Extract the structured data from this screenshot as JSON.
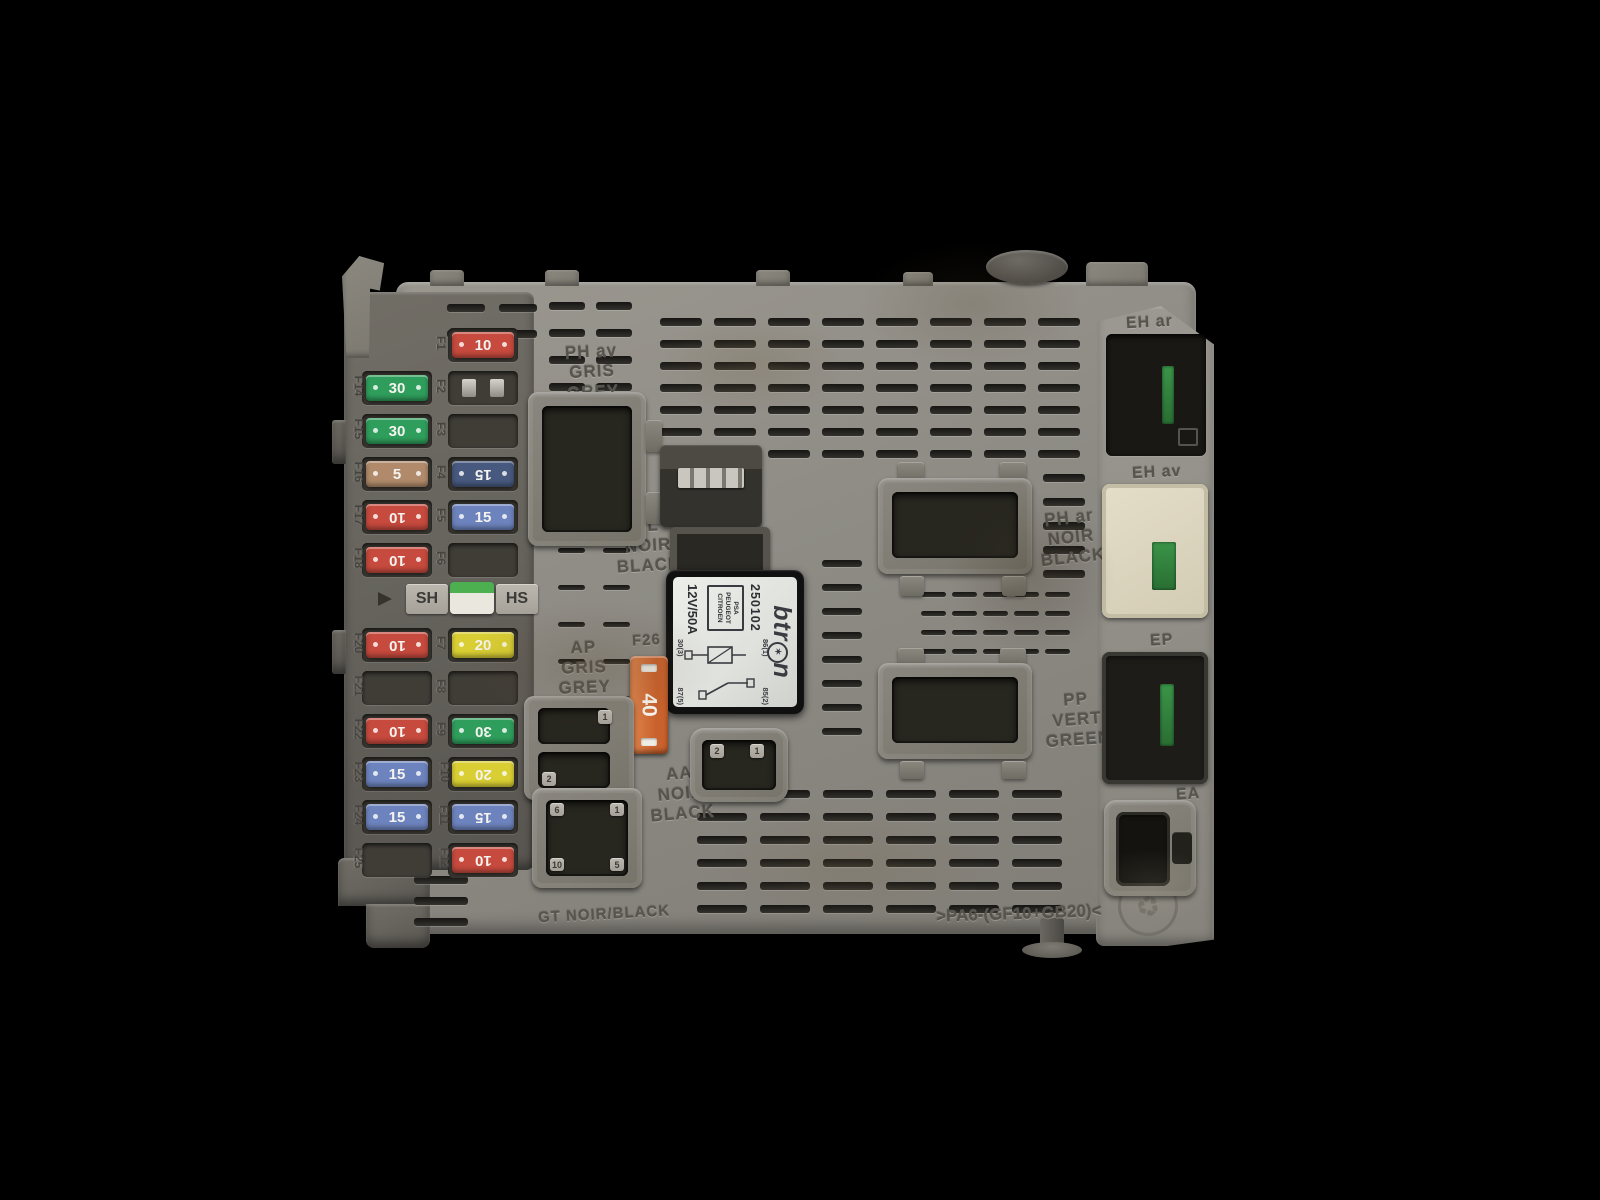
{
  "photo": {
    "background": "#000000",
    "subject": "Grey automotive BSI fuse and relay box module photographed from above on a black background"
  },
  "colors": {
    "red10": "#c64a3e",
    "green30": "#2f9e5c",
    "tan5": "#b08a6b",
    "navy15": "#47597e",
    "blue15": "#6d83bd",
    "yellow20": "#d9ce33",
    "orange40": "#d4703a",
    "sh_green": "#4caf50",
    "body_grey": "#8e8b85",
    "pcb_green": "#2f7d3c"
  },
  "fuse_panel": {
    "sh_label": "SH",
    "hs_label": "HS",
    "left_labels": [
      {
        "label": "F14",
        "group": "upper",
        "row": 1
      },
      {
        "label": "F15",
        "group": "upper",
        "row": 2
      },
      {
        "label": "F16",
        "group": "upper",
        "row": 3
      },
      {
        "label": "F17",
        "group": "upper",
        "row": 4
      },
      {
        "label": "F18",
        "group": "upper",
        "row": 5
      },
      {
        "label": "F20",
        "group": "lower",
        "row": 0
      },
      {
        "label": "F21",
        "group": "lower",
        "row": 1
      },
      {
        "label": "F22",
        "group": "lower",
        "row": 2
      },
      {
        "label": "F23",
        "group": "lower",
        "row": 3
      },
      {
        "label": "F24",
        "group": "lower",
        "row": 4
      },
      {
        "label": "F25",
        "group": "lower",
        "row": 5
      }
    ],
    "mid_labels": [
      {
        "label": "F1",
        "group": "upper",
        "row": 0
      },
      {
        "label": "F2",
        "group": "upper",
        "row": 1
      },
      {
        "label": "F3",
        "group": "upper",
        "row": 2
      },
      {
        "label": "F4",
        "group": "upper",
        "row": 3
      },
      {
        "label": "F5",
        "group": "upper",
        "row": 4
      },
      {
        "label": "F6",
        "group": "upper",
        "row": 5
      },
      {
        "label": "F7",
        "group": "lower",
        "row": 0
      },
      {
        "label": "F8",
        "group": "lower",
        "row": 1
      },
      {
        "label": "F9",
        "group": "lower",
        "row": 2
      },
      {
        "label": "F10",
        "group": "lower",
        "row": 3
      },
      {
        "label": "F11",
        "group": "lower",
        "row": 4
      },
      {
        "label": "F12",
        "group": "lower",
        "row": 5
      }
    ],
    "fuses": [
      {
        "slot": "F1",
        "group": "upper",
        "col": "right",
        "row": 0,
        "type": "fuse",
        "value": "10",
        "color": "red10",
        "flipped": false
      },
      {
        "slot": "F2",
        "group": "upper",
        "col": "right",
        "row": 1,
        "type": "clips"
      },
      {
        "slot": "F3",
        "group": "upper",
        "col": "right",
        "row": 2,
        "type": "empty"
      },
      {
        "slot": "F4",
        "group": "upper",
        "col": "right",
        "row": 3,
        "type": "fuse",
        "value": "15",
        "color": "navy15",
        "flipped": true
      },
      {
        "slot": "F5",
        "group": "upper",
        "col": "right",
        "row": 4,
        "type": "fuse",
        "value": "15",
        "color": "blue15",
        "flipped": false
      },
      {
        "slot": "F6",
        "group": "upper",
        "col": "right",
        "row": 5,
        "type": "empty"
      },
      {
        "slot": "F14",
        "group": "upper",
        "col": "left",
        "row": 1,
        "type": "fuse",
        "value": "30",
        "color": "green30",
        "flipped": false
      },
      {
        "slot": "F15",
        "group": "upper",
        "col": "left",
        "row": 2,
        "type": "fuse",
        "value": "30",
        "color": "green30",
        "flipped": false
      },
      {
        "slot": "F16",
        "group": "upper",
        "col": "left",
        "row": 3,
        "type": "fuse",
        "value": "5",
        "color": "tan5",
        "flipped": false
      },
      {
        "slot": "F17",
        "group": "upper",
        "col": "left",
        "row": 4,
        "type": "fuse",
        "value": "10",
        "color": "red10",
        "flipped": true
      },
      {
        "slot": "F18",
        "group": "upper",
        "col": "left",
        "row": 5,
        "type": "fuse",
        "value": "10",
        "color": "red10",
        "flipped": true
      },
      {
        "slot": "F7",
        "group": "lower",
        "col": "right",
        "row": 0,
        "type": "fuse",
        "value": "20",
        "color": "yellow20",
        "flipped": false
      },
      {
        "slot": "F8",
        "group": "lower",
        "col": "right",
        "row": 1,
        "type": "empty"
      },
      {
        "slot": "F9",
        "group": "lower",
        "col": "right",
        "row": 2,
        "type": "fuse",
        "value": "30",
        "color": "green30",
        "flipped": true
      },
      {
        "slot": "F10",
        "group": "lower",
        "col": "right",
        "row": 3,
        "type": "fuse",
        "value": "20",
        "color": "yellow20",
        "flipped": true
      },
      {
        "slot": "F11",
        "group": "lower",
        "col": "right",
        "row": 4,
        "type": "fuse",
        "value": "15",
        "color": "blue15",
        "flipped": true
      },
      {
        "slot": "F12",
        "group": "lower",
        "col": "right",
        "row": 5,
        "type": "fuse",
        "value": "10",
        "color": "red10",
        "flipped": true
      },
      {
        "slot": "F20",
        "group": "lower",
        "col": "left",
        "row": 0,
        "type": "fuse",
        "value": "10",
        "color": "red10",
        "flipped": true
      },
      {
        "slot": "F21",
        "group": "lower",
        "col": "left",
        "row": 1,
        "type": "empty"
      },
      {
        "slot": "F22",
        "group": "lower",
        "col": "left",
        "row": 2,
        "type": "fuse",
        "value": "10",
        "color": "red10",
        "flipped": true
      },
      {
        "slot": "F23",
        "group": "lower",
        "col": "left",
        "row": 3,
        "type": "fuse",
        "value": "15",
        "color": "blue15",
        "flipped": false
      },
      {
        "slot": "F24",
        "group": "lower",
        "col": "left",
        "row": 4,
        "type": "fuse",
        "value": "15",
        "color": "blue15",
        "flipped": false
      },
      {
        "slot": "F25",
        "group": "lower",
        "col": "left",
        "row": 5,
        "type": "empty"
      }
    ],
    "maxi_fuse": {
      "slot_label": "F26",
      "value": "40",
      "color": "orange40"
    }
  },
  "molded": {
    "ph_av": [
      "PH av",
      "GRIS",
      "GREY"
    ],
    "pl": [
      "PL",
      "NOIR",
      "BLACK"
    ],
    "ap": [
      "AP",
      "GRIS",
      "GREY"
    ],
    "aa": [
      "AA",
      "NOIR",
      "BLACK"
    ],
    "ph_ar": [
      "PH ar",
      "NOIR",
      "BLACK"
    ],
    "pp": [
      "PP",
      "VERT",
      "GREEN"
    ],
    "eh_ar": "EH ar",
    "eh_av": "EH av",
    "ep": "EP",
    "ea": "EA",
    "f26": "F26",
    "material": ">PA6-(GF10+GB20)<",
    "gt": "GT NOIR/BLACK",
    "recycle": "♻"
  },
  "relay": {
    "brand_left": "btr",
    "brand_o": "✶",
    "brand_right": "n",
    "part_number": "250102",
    "oem_line1": "PSA",
    "oem_line2": "PEUGEOT",
    "oem_line3": "CITROEN",
    "rating": "12V/50A",
    "pin_86": "86(1)",
    "pin_30": "30(3)",
    "pin_85": "85(2)",
    "pin_87": "87(5)"
  },
  "connector_pins": {
    "aa_left": "2",
    "aa_right": "1",
    "ap_top": "1",
    "ap_bottom": "2",
    "gt_tl": "6",
    "gt_tr": "1",
    "gt_bl": "10",
    "gt_br": "5"
  }
}
